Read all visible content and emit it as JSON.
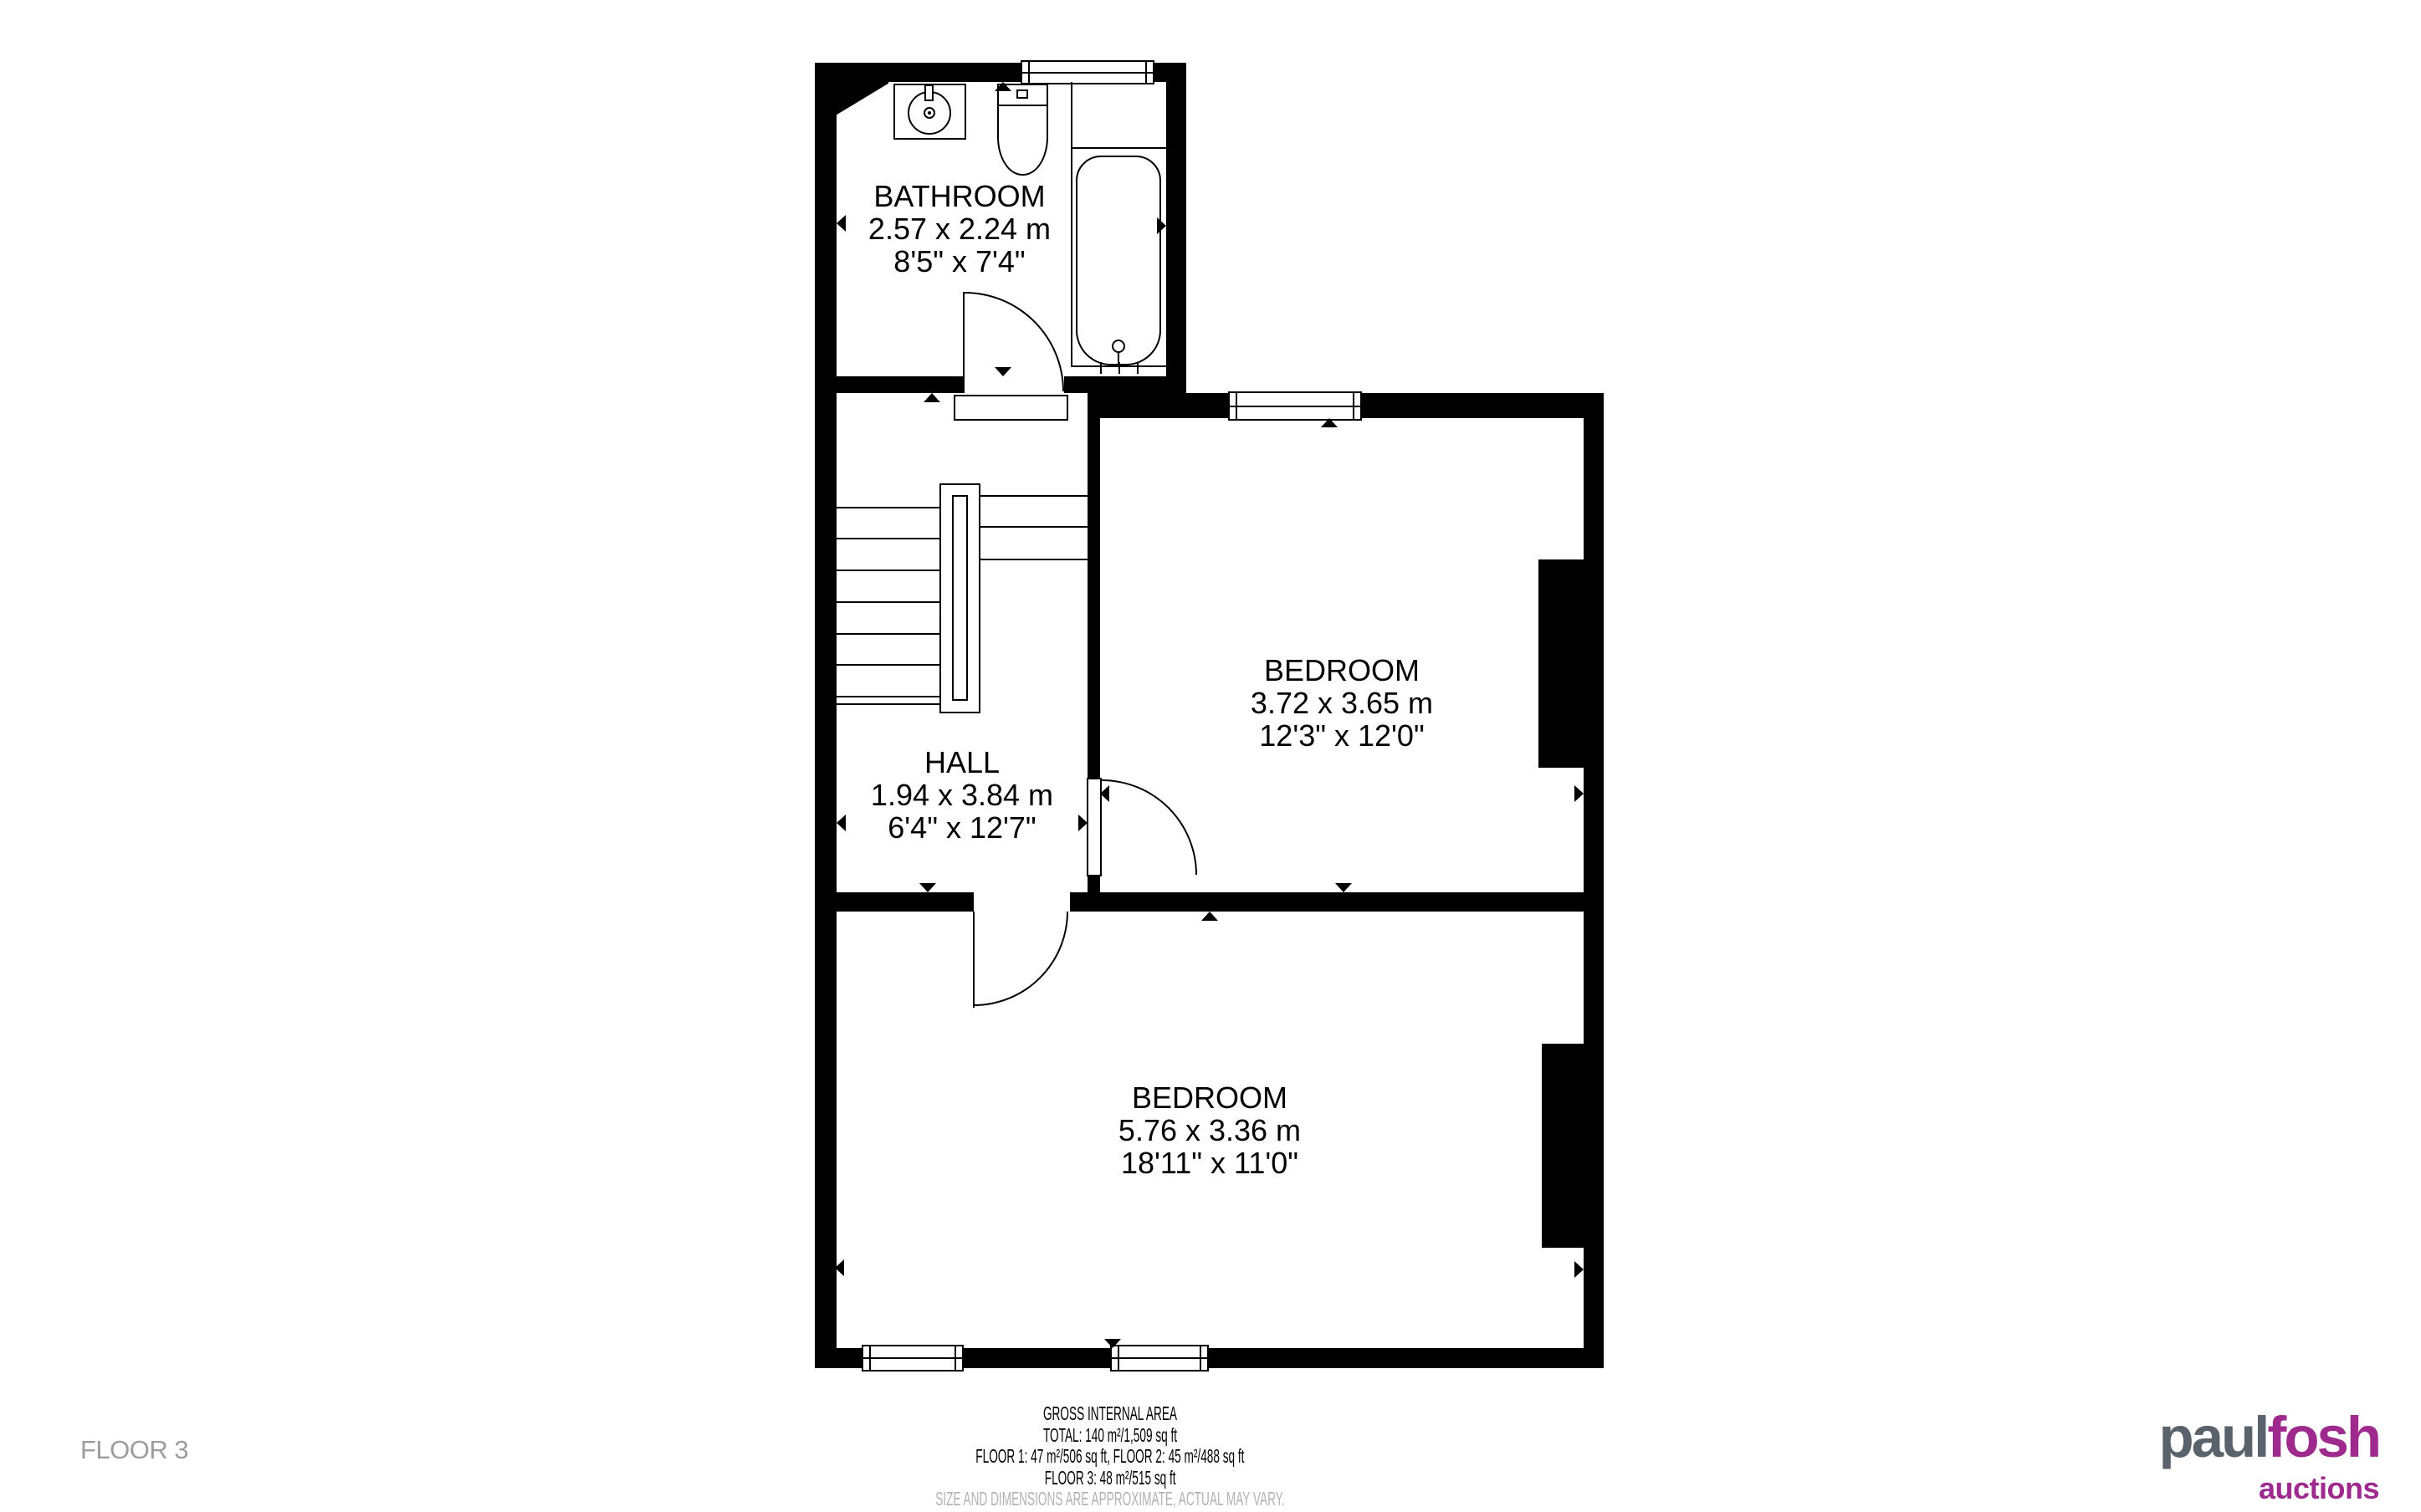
{
  "plan": {
    "rooms": {
      "bathroom": {
        "name": "BATHROOM",
        "metric": "2.57 x 2.24 m",
        "imperial": "8'5\" x 7'4\""
      },
      "hall": {
        "name": "HALL",
        "metric": "1.94 x 3.84 m",
        "imperial": "6'4\" x 12'7\""
      },
      "bedroom1": {
        "name": "BEDROOM",
        "metric": "3.72 x 3.65 m",
        "imperial": "12'3\" x 12'0\""
      },
      "bedroom2": {
        "name": "BEDROOM",
        "metric": "5.76 x 3.36 m",
        "imperial": "18'11\" x 11'0\""
      }
    },
    "fixtures": [
      "sink",
      "toilet",
      "bathtub",
      "staircase"
    ]
  },
  "footer": {
    "line1": "GROSS INTERNAL AREA",
    "line2": "TOTAL: 140 m²/1,509 sq ft",
    "line3": "FLOOR 1: 47 m²/506 sq ft, FLOOR 2: 45 m²/488 sq ft",
    "line4": "FLOOR 3: 48 m²/515 sq ft",
    "disclaimer": "SIZE AND DIMENSIONS ARE APPROXIMATE, ACTUAL MAY VARY."
  },
  "floor_label": "FLOOR 3",
  "logo": {
    "part1": "paul",
    "part2": "fosh",
    "tagline": "auctions",
    "part1_color": "#5a636b",
    "accent_color": "#9e2a8e"
  },
  "colors": {
    "wall": "#000000",
    "disclaimer_text": "#b2b2b2",
    "floor_label_text": "#9c9c9c"
  }
}
